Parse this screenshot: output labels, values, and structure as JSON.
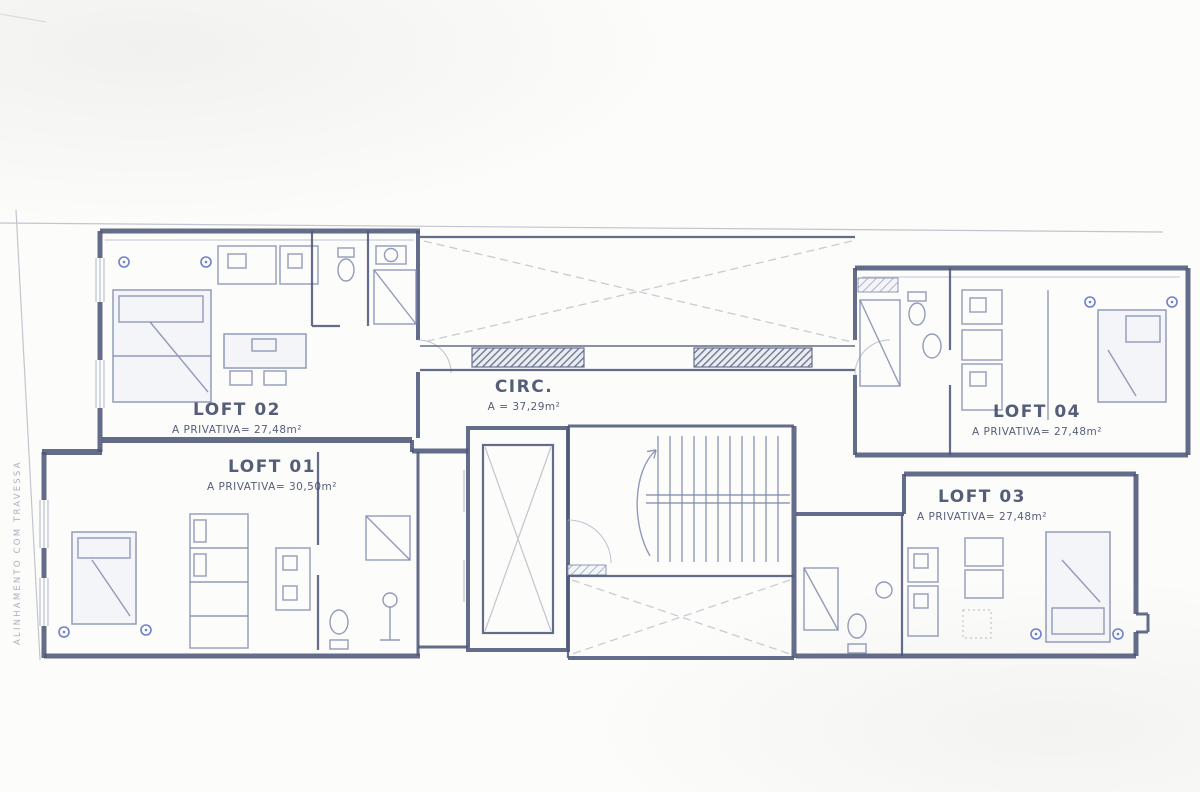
{
  "plan": {
    "site": {
      "boundary_label": "ALINHAMENTO COM TRAVESSA"
    },
    "units": {
      "loft02": {
        "name": "LOFT 02",
        "area": "A PRIVATIVA= 27,48m²"
      },
      "loft01": {
        "name": "LOFT 01",
        "area": "A PRIVATIVA= 30,50m²"
      },
      "loft04": {
        "name": "LOFT 04",
        "area": "A PRIVATIVA= 27,48m²"
      },
      "loft03": {
        "name": "LOFT 03",
        "area": "A PRIVATIVA= 27,48m²"
      },
      "circulation": {
        "name": "CIRC.",
        "area": "A = 37,29m²"
      }
    },
    "colors": {
      "wall": "#4d5878",
      "furniture": "#7f8aae",
      "accent_fixture": "#4a5fc0",
      "faint_line": "#c2c5cd",
      "label_text": "#3f4968",
      "paper": "#fcfcfb"
    }
  }
}
